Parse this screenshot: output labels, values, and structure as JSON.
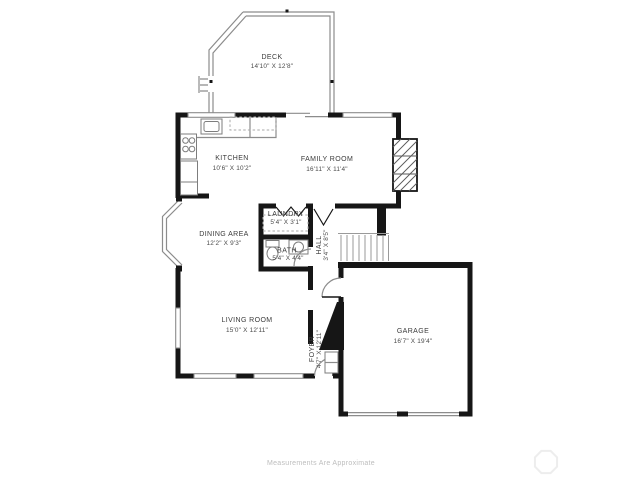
{
  "document": {
    "type": "floor-plan",
    "footer": {
      "disclaimer": "Measurements Are Approximate",
      "watermark_icon": "octagon-logo"
    },
    "colors": {
      "background": "#ffffff",
      "wall": "#161616",
      "thin_line": "#8c8c8c",
      "label_text": "#3b3b3b",
      "footer_text": "#bdbdbd",
      "watermark": "#ededed"
    }
  },
  "rooms": {
    "deck": {
      "name": "DECK",
      "dims": "14'10\" X 12'8\""
    },
    "kitchen": {
      "name": "KITCHEN",
      "dims": "10'6\" X 10'2\""
    },
    "family_room": {
      "name": "FAMILY ROOM",
      "dims": "16'11\" X 11'4\""
    },
    "laundry": {
      "name": "LAUNDRY",
      "dims": "5'4\" X 3'1\""
    },
    "dining_area": {
      "name": "DINING AREA",
      "dims": "12'2\" X 9'3\""
    },
    "bath": {
      "name": "BATH",
      "dims": "5'4\" X 4'4\""
    },
    "hall": {
      "name": "HALL",
      "dims": "3'4\" X 8'5\""
    },
    "living_room": {
      "name": "LIVING ROOM",
      "dims": "15'0\" X 12'11\""
    },
    "foyer": {
      "name": "FOYER",
      "dims": "4'7\" X 12'11\""
    },
    "garage": {
      "name": "GARAGE",
      "dims": "16'7\" X 19'4\""
    }
  }
}
